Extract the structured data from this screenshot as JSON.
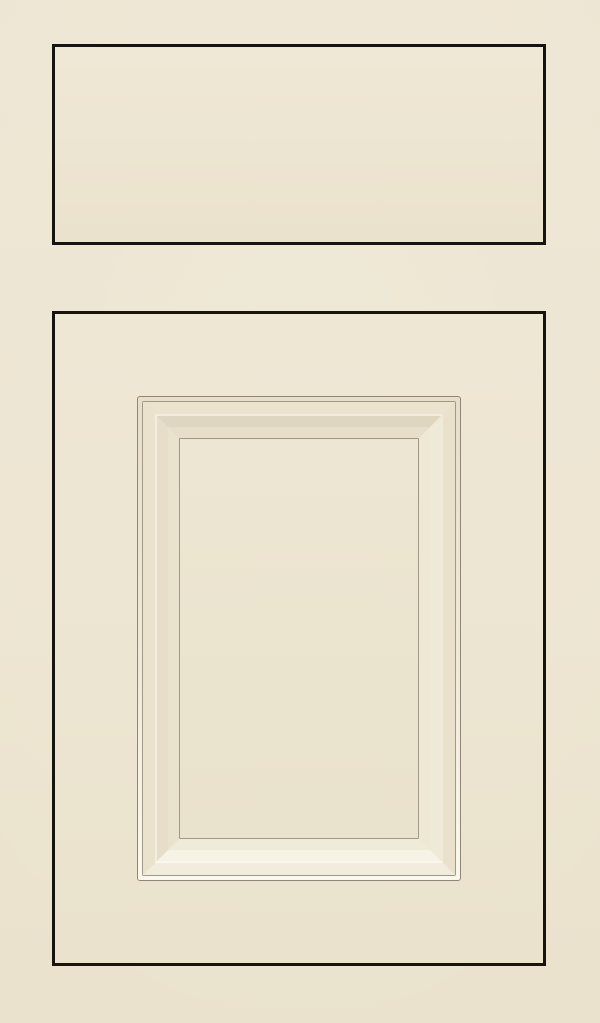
{
  "image": {
    "description": "Cream painted cabinet sample: slab drawer front above an applied-molding raised panel door",
    "text_content": "",
    "drawer_style": "slab-drawer-front",
    "door_style": "applied-molding-raised-panel-door"
  },
  "colors": {
    "background": "#EDE5D1",
    "outline": "#17130E",
    "molding-line": "#8F8677",
    "molding-line-soft": "#A19888",
    "panel": "#EBE4CF",
    "highlight": "#FAF7EC",
    "bevel-shadow": "#DFD6BF",
    "face": "#ECE5D1"
  }
}
